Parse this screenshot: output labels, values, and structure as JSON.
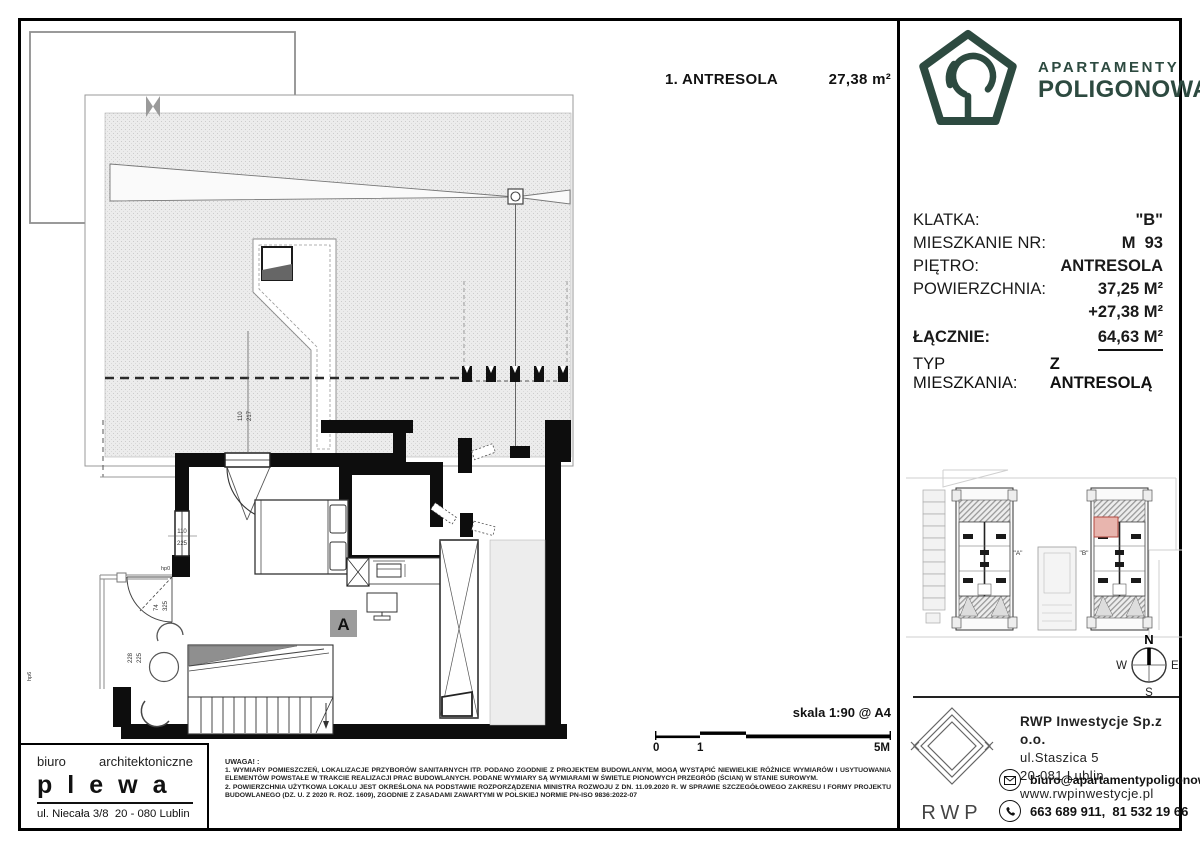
{
  "sheet": {
    "title": "1. ANTRESOLA",
    "area": "27,38 m²",
    "scale": "skala 1:90 @ A4",
    "scale_ticks": [
      "0",
      "1",
      "5M"
    ]
  },
  "brand": {
    "line1": "APARTAMENTY",
    "line2": "POLIGONOWA",
    "color": "#2d4a40"
  },
  "unit_info": {
    "rows": [
      {
        "label": "KLATKA:",
        "value": "\"B\""
      },
      {
        "label": "MIESZKANIE NR:",
        "value": "M  93"
      },
      {
        "label": "PIĘTRO:",
        "value": "ANTRESOLA"
      },
      {
        "label": "POWIERZCHNIA:",
        "value": "37,25 M²"
      },
      {
        "label": "",
        "value": "+27,38 M²"
      },
      {
        "label": "ŁĄCZNIE:",
        "value": "64,63 M²"
      }
    ],
    "type_label": "TYP MIESZKANIA:",
    "type_value": "Z ANTRESOLĄ"
  },
  "plan": {
    "room_label": "A",
    "dims": {
      "top_w": "110",
      "top_h": "217",
      "left_w": "110",
      "left_h": "225",
      "hp0": "hp0",
      "door_w": "74",
      "door_h": "325",
      "entry_w": "228",
      "entry_h": "225",
      "hp6": "hp6"
    }
  },
  "site_plan": {
    "building_a": "\"A\"",
    "building_b": "\"B\"",
    "highlight_color": "#e8b5ae"
  },
  "compass": {
    "n": "N",
    "e": "E",
    "s": "S",
    "w": "W"
  },
  "architect": {
    "title_left": "biuro",
    "title_right": "architektoniczne",
    "name": "plewa",
    "address": "ul. Niecała 3/8  20 - 080 Lublin"
  },
  "notes": {
    "heading": "UWAGA! :",
    "item1": "1. WYMIARY POMIESZCZEŃ, LOKALIZACJE PRZYBORÓW SANITARNYCH ITP. PODANO ZGODNIE Z PROJEKTEM BUDOWLANYM, MOGĄ WYSTĄPIĆ NIEWIELKIE RÓŻNICE WYMIARÓW I USYTUOWANIA ELEMENTÓW POWSTAŁE W TRAKCIE REALIZACJI PRAC BUDOWLANYCH. PODANE WYMIARY SĄ WYMIARAMI W ŚWIETLE PIONOWYCH PRZEGRÓD (ŚCIAN) W STANIE SUROWYM.",
    "item2": "2. POWIERZCHNIA UŻYTKOWA LOKALU JEST OKREŚLONA NA PODSTAWIE ROZPORZĄDZENIA MINISTRA ROZWOJU Z DN. 11.09.2020 R. W SPRAWIE SZCZEGÓŁOWEGO ZAKRESU I FORMY PROJEKTU BUDOWLANEGO (DZ. U. Z 2020 R. ROZ. 1609), ZGODNIE Z ZASADAMI ZAWARTYMI W POLSKIEJ NORMIE PN-ISO 9836:2022-07"
  },
  "developer": {
    "logo_text": "RWP",
    "company": "RWP Inwestycje Sp.z o.o.",
    "street": "ul.Staszica 5",
    "city": "20-081 Lublin",
    "website": "www.rwpinwestycje.pl",
    "email": "biuro@apartamentypoligonowa.pl",
    "phones": "663 689 911,  81 532 19 66"
  }
}
